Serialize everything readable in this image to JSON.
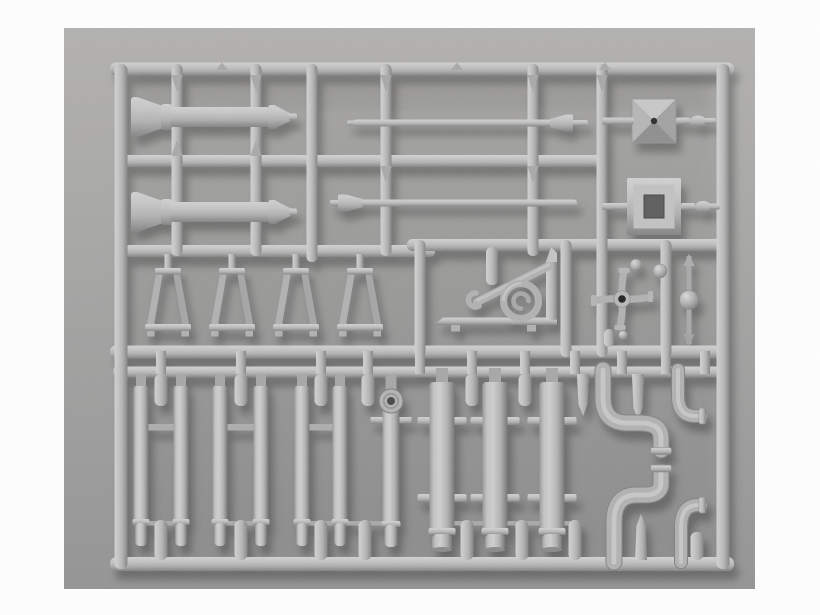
{
  "scene": {
    "label": "Photograph of a gray plastic injection-molded model kit sprue holding pipe, lamp-post, bracket and fitting parts"
  },
  "palette": {
    "page_bg": "#ffffff",
    "backdrop_top": "#b2b1af",
    "backdrop_mid": "#a3a3a2",
    "backdrop_bottom": "#949494",
    "plastic_highlight": "#d1d1d1",
    "plastic_light": "#c4c4c4",
    "plastic_mid": "#b1b1b1",
    "plastic_shadow": "#848484",
    "plastic_deep": "#767676",
    "gate_gray": "#a9a9a9",
    "hole_dark": "#2e2e2e",
    "hole_square": "#5d5d5d",
    "shadow_color": "#000000",
    "shadow_opacity": 0.28
  },
  "geometry": {
    "photo": {
      "x": 64,
      "y": 28,
      "w": 691,
      "h": 561
    },
    "rails": [
      {
        "y": 69,
        "x1": 115,
        "x2": 729,
        "th": 13
      },
      {
        "y": 161,
        "x1": 121,
        "x2": 602,
        "th": 12
      },
      {
        "y": 251,
        "x1": 121,
        "x2": 430,
        "th": 12
      },
      {
        "y": 245,
        "x1": 412,
        "x2": 723,
        "th": 12
      },
      {
        "y": 352,
        "x1": 115,
        "x2": 723,
        "th": 13
      },
      {
        "y": 372,
        "x1": 118,
        "x2": 722,
        "th": 11
      },
      {
        "y": 564,
        "x1": 115,
        "x2": 729,
        "th": 14
      }
    ],
    "runners": [
      {
        "x": 121,
        "y1": 69,
        "y2": 564,
        "th": 13
      },
      {
        "x": 723,
        "y1": 69,
        "y2": 564,
        "th": 13
      },
      {
        "x": 177,
        "y1": 69,
        "y2": 251,
        "th": 11
      },
      {
        "x": 256,
        "y1": 69,
        "y2": 251,
        "th": 11
      },
      {
        "x": 312,
        "y1": 69,
        "y2": 257,
        "th": 11
      },
      {
        "x": 386,
        "y1": 69,
        "y2": 251,
        "th": 11
      },
      {
        "x": 533,
        "y1": 69,
        "y2": 251,
        "th": 11
      },
      {
        "x": 602,
        "y1": 69,
        "y2": 352,
        "th": 11
      },
      {
        "x": 420,
        "y1": 245,
        "y2": 352,
        "th": 11
      },
      {
        "x": 566,
        "y1": 245,
        "y2": 352,
        "th": 11
      },
      {
        "x": 666,
        "y1": 245,
        "y2": 352,
        "th": 11
      }
    ],
    "band_connectors": [
      161,
      241,
      321,
      368,
      420,
      472,
      525,
      575,
      622,
      666,
      705
    ],
    "nubs_top": [
      222,
      457,
      605
    ],
    "drips_down": [
      {
        "x": 177,
        "y": 75
      },
      {
        "x": 256,
        "y": 75
      },
      {
        "x": 386,
        "y": 75
      },
      {
        "x": 533,
        "y": 75
      },
      {
        "x": 602,
        "y": 75
      },
      {
        "x": 386,
        "y": 166
      },
      {
        "x": 533,
        "y": 166
      }
    ],
    "drips_up": [
      {
        "x": 177,
        "y": 156
      },
      {
        "x": 256,
        "y": 156
      }
    ],
    "top_stubs": [
      {
        "x": 161
      },
      {
        "x": 241
      },
      {
        "x": 321
      },
      {
        "x": 368
      },
      {
        "x": 472
      },
      {
        "x": 525
      },
      {
        "x": 583,
        "len": 42,
        "pointed": true
      },
      {
        "x": 638,
        "len": 46,
        "pointed": true
      }
    ],
    "bottom_stubs": [
      {
        "x": 161
      },
      {
        "x": 241
      },
      {
        "x": 321
      },
      {
        "x": 365
      },
      {
        "x": 467
      },
      {
        "x": 522
      },
      {
        "x": 575
      },
      {
        "x": 641,
        "len": 46,
        "pointed": true
      },
      {
        "x": 697,
        "len": 28
      }
    ],
    "gates": [
      [
        134,
        181
      ],
      [
        213,
        261
      ],
      [
        295,
        340
      ],
      [
        340,
        391
      ],
      [
        435,
        467
      ],
      [
        467,
        495
      ],
      [
        495,
        522
      ],
      [
        522,
        552
      ],
      [
        552,
        575
      ]
    ],
    "gate_y": 521,
    "bollards": [
      {
        "cy": 117
      },
      {
        "cy": 212
      }
    ],
    "rods": [
      {
        "y": 123,
        "cone": "right"
      },
      {
        "y": 203,
        "cone": "left"
      }
    ],
    "pyramid_cap": {
      "x": 632,
      "y": 99,
      "size": 44
    },
    "square_frame": {
      "x": 627,
      "y": 178,
      "w": 54,
      "h": 57,
      "hole": {
        "x": 644,
        "y": 195,
        "w": 20,
        "h": 23
      }
    },
    "trapezoids": {
      "cxs": [
        168,
        232,
        296,
        360
      ],
      "top_y": 268,
      "bot_y": 324,
      "top_w": 26,
      "bot_w": 46
    },
    "bracket_stub": {
      "x": 486,
      "y": 247,
      "w": 12,
      "h": 38
    },
    "cross_junction": {
      "cx": 622,
      "cy": 299,
      "arm": 28,
      "hub_r": 8.2,
      "hole_r": 3.8
    },
    "balls": [
      {
        "cx": 636,
        "cy": 265,
        "r": 6
      },
      {
        "cx": 660,
        "cy": 271,
        "r": 7
      }
    ],
    "small_stubs": [
      {
        "x": 609,
        "y1": 329,
        "y2": 347
      }
    ],
    "small_balls": [
      {
        "cx": 623,
        "cy": 335,
        "r": 4.5
      }
    ],
    "ball_rod": {
      "x": 689,
      "y1": 252,
      "y2": 348,
      "ball_cy": 300,
      "ball_r": 9.5
    },
    "thin_pipes": {
      "xs": [
        141,
        181,
        220,
        261,
        302,
        340
      ],
      "pairs": [
        [
          141,
          181
        ],
        [
          220,
          261
        ],
        [
          302,
          340
        ]
      ],
      "tab_y": 424
    },
    "flanged_pipe": {
      "x": 391,
      "flange_cy": 401,
      "flange_r": 12,
      "collar_y": 417
    },
    "thick_pipes": {
      "xs": [
        442,
        495,
        552
      ],
      "collar1_y": 417,
      "collar2_y": 494
    },
    "s_pipes": [
      {
        "d": "M603,370 L603,398 Q603,423 628,423 L640,423 Q661,423 661,438 L661,450",
        "collar": {
          "x": 650.5,
          "y": 447.5,
          "w": 21,
          "h": 7
        }
      },
      {
        "d": "M614,562 L614,522 Q614,495 636,495 L645,495 Q661,495 661,483 L661,472",
        "collar": {
          "x": 650.5,
          "y": 465,
          "w": 21,
          "h": 7
        }
      }
    ],
    "elbows": [
      {
        "d": "M678,370 L678,396 Q678,416 695,416 L701,416",
        "flange": {
          "x": 699,
          "y": 408,
          "w": 7,
          "h": 16
        }
      },
      {
        "d": "M681,562 L681,527 Q681,505 698,505 L701,505",
        "flange": {
          "x": 699,
          "y": 497,
          "w": 7,
          "h": 16
        }
      }
    ]
  }
}
